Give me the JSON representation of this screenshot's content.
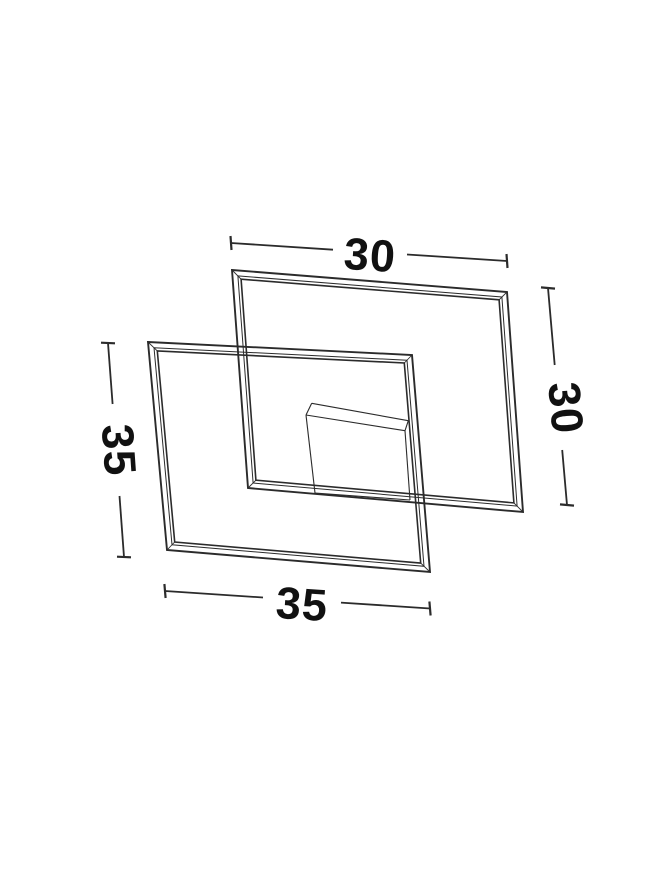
{
  "page": {
    "background": "#ffffff"
  },
  "diagram": {
    "dims": {
      "top": "30",
      "right": "30",
      "left": "35",
      "bottom": "35"
    },
    "colors": {
      "line": "#2b2b2b",
      "text": "#111111"
    }
  }
}
